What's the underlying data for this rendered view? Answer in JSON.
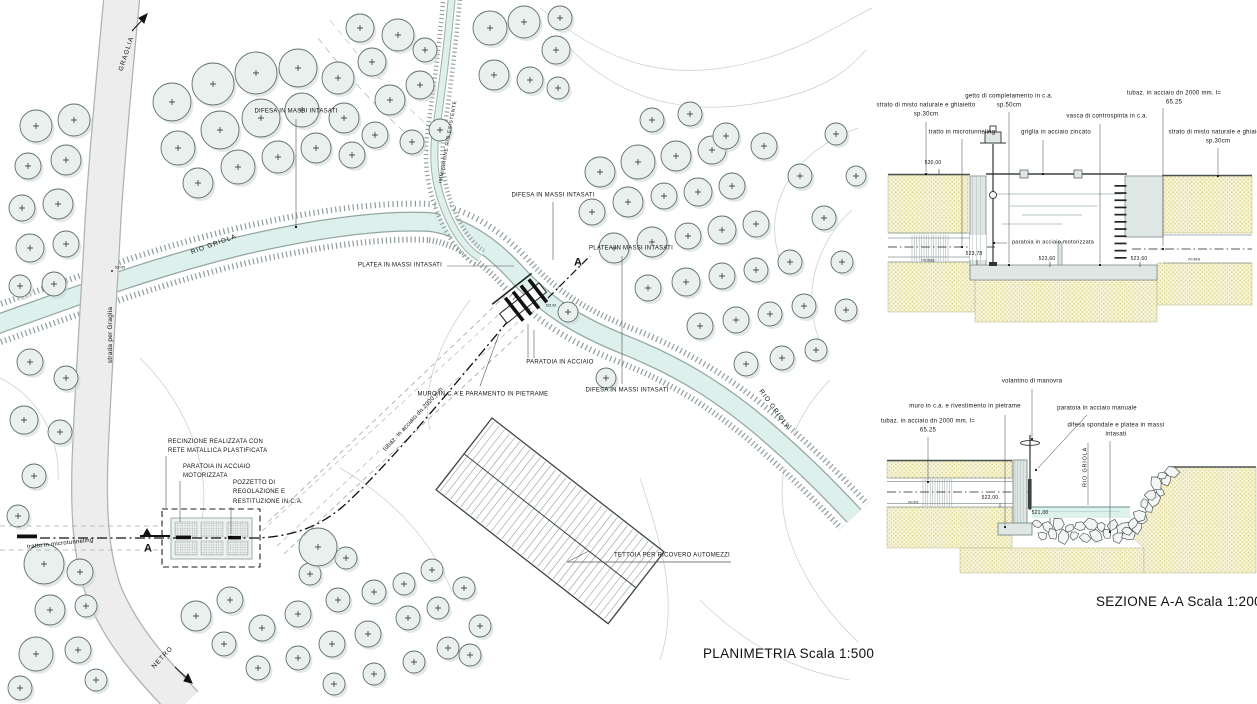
{
  "plan": {
    "title": "PLANIMETRIA  Scala 1:500",
    "labels": {
      "road_top": "GRAGLIA",
      "road_left": "strada per Graglia",
      "road_bottom": "NETRO",
      "river1": "RIO GRIOLA",
      "river2": "RIO GRIOLA",
      "tributary": "IMMISSIONE RIO ESISTENTE",
      "difesa1": "DIFESA IN MASSI INTASATI",
      "difesa2": "DIFESA IN MASSI INTASATI",
      "difesa3": "DIFESA IN MASSI INTASATI",
      "platea1": "PLATEA IN MASSI INTASATI",
      "platea2": "PLATEA IN MASSI INTASATI",
      "paratoia": "PARATOIA IN ACCIAIO",
      "muro": "MURO IN C.A E PARAMENTO IN PIETRAME",
      "tubaz_pipe": "tubaz. in acciaio dn 2000 mm",
      "recinzione": "RECINZIONE REALIZZATA CON RETE MATALLICA PLASTIFICATA",
      "paratoia_mot": "PARATOIA IN ACCIAIO MOTORIZZATA",
      "pozzetto": "POZZETTO DI REGOLAZIONE E RESTITUZIONE IN C.A.",
      "microtunneling": "tratto in microtunneling",
      "tettoia": "TETTOIA PER RICOVERO AUTOMEZZI",
      "section_a": "A",
      "elev_road": "530.09",
      "elev_weir": "521.00"
    }
  },
  "sections": {
    "title": "SEZIONE A-A Scala 1:200",
    "top": {
      "strato_sx": "strato di misto naturale e ghiaietto sp.30cm",
      "tratto": "tratto in microtunneling",
      "getto": "getto di completamento in c.a. sp.50cm",
      "griglia": "griglia in acciaio zincato",
      "vasca": "vasca di controspinta in c.a.",
      "tubaz": "tubaz. in acciaio dn 2000 mm. l= 65.25",
      "strato_dx": "strato di misto naturale e ghiaietto sp.30cm",
      "paratoia": "paratoia in acciaio motorizzata",
      "elev1": "530,00",
      "elev2": "523,78",
      "elev3": "523,60",
      "elev4": "523,60",
      "slope_sx": "i=0.0693",
      "slope_dx": "i=0.49%"
    },
    "bottom": {
      "volantino": "volantino di manovra",
      "muro": "muro in c.a. e rivestimento in pietrame",
      "tubaz": "tubaz. in acciaio dn 2000 mm. l= 65.25",
      "paratoia": "paratoia in acciaio manuale",
      "difesa": "difesa spondale e platea in massi intasati",
      "rio": "RIO GRIOLA",
      "elev1": "522,00",
      "elev2": "521,00",
      "slope": "i=0.5%"
    }
  }
}
